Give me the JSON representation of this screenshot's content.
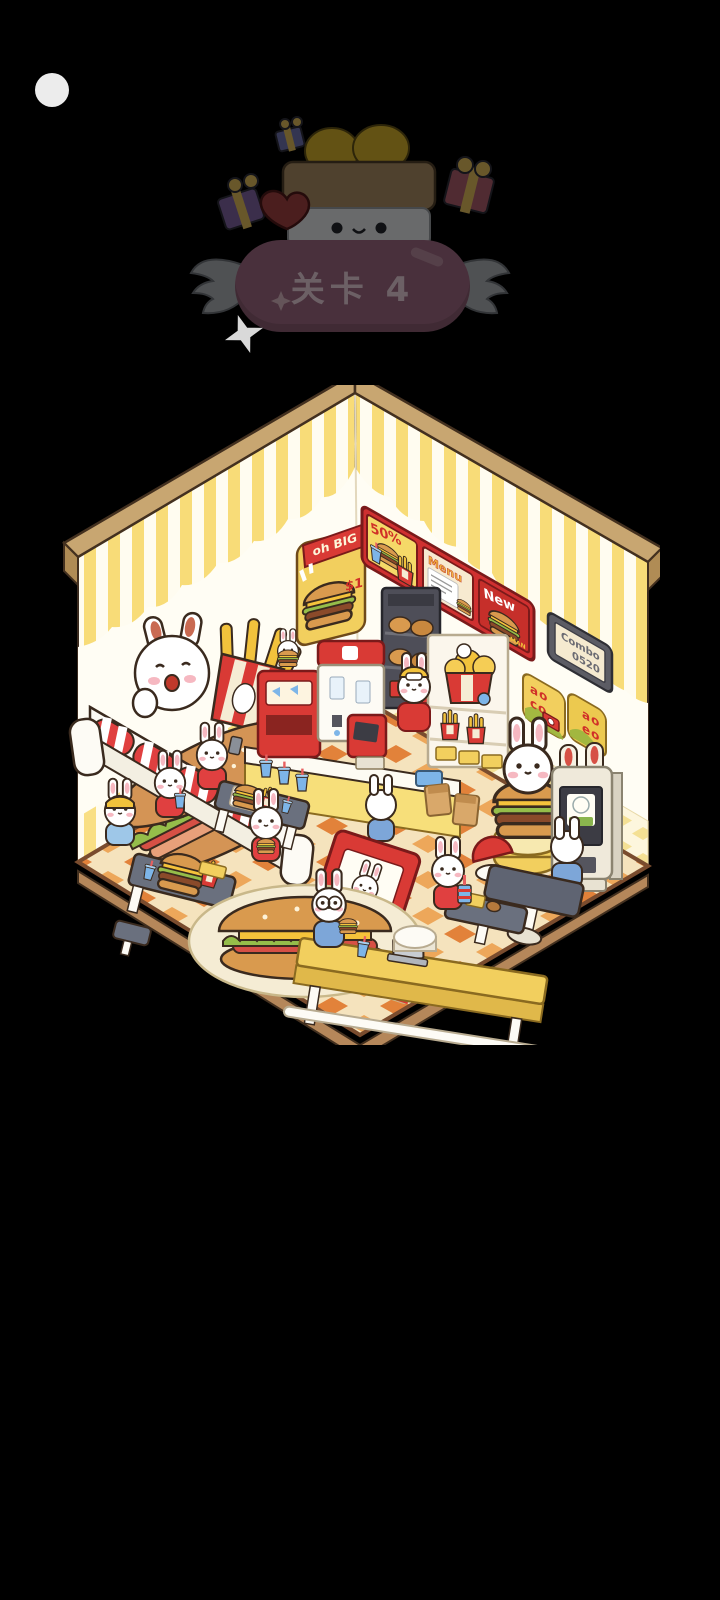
{
  "level_banner": {
    "title": "关卡 4"
  },
  "room": {
    "big_poster": {
      "title": "oh BIG",
      "price": "$1"
    },
    "menu_board": {
      "panel1": "50%",
      "panel2": "Menu",
      "panel3": "New",
      "panel3_sub": "MAN"
    },
    "combo_sign": {
      "line1": "Combo",
      "line2": "0520"
    },
    "sticker1": {
      "line1": "ao",
      "line2": "co"
    },
    "sticker2": {
      "line1": "ao",
      "line2": "eo"
    }
  },
  "palette": {
    "background": "#000000",
    "banner_pink": "#b06789",
    "accent_red": "#d93a35",
    "wall_yellow": "#f8dc78",
    "floor_orange": "#e2823a",
    "wood_trim": "#c8a671"
  }
}
